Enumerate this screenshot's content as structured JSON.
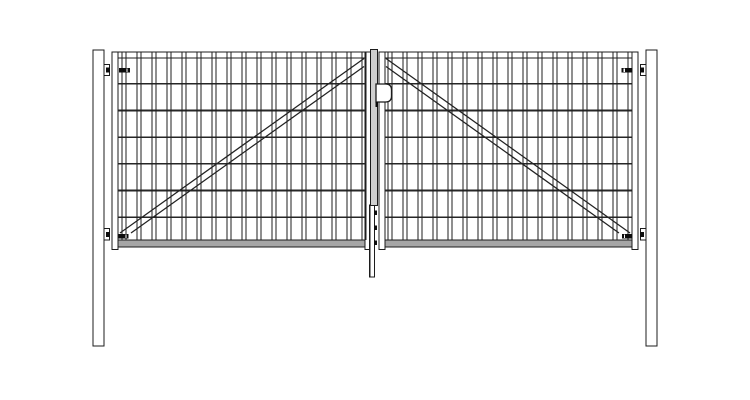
{
  "title": "Double-leaf wire-mesh swing gate - front elevation technical drawing",
  "canvas": {
    "width": 750,
    "height": 400,
    "background": "#ffffff"
  },
  "colors": {
    "outline": "#1c1c1c",
    "wire_vertical": "#1f1f1f",
    "wire_horizontal": "#262626",
    "brace": "#222222",
    "fill_white": "#ffffff",
    "fill_rail": "#a6a6a6",
    "fill_profile": "#cfcfcf",
    "fill_black": "#0d0d0d"
  },
  "posts": {
    "left": {
      "x": 93,
      "y": 50,
      "w": 11,
      "h": 296
    },
    "right": {
      "x": 646,
      "y": 50,
      "w": 11,
      "h": 296
    }
  },
  "leaves": {
    "left": {
      "frame": {
        "x1": 112,
        "x2": 371,
        "top": 52,
        "bottom": 247,
        "stile_w": 6,
        "top_rail_h": 6,
        "bottom_rail_y": 240,
        "stile_foot_y": 249.5
      },
      "mesh": {
        "bar_first_x": 122,
        "bar_last_x": 362,
        "bar_pitch": 15,
        "bar_pair_gap": 4,
        "bar_top_y": 52,
        "bar_bottom_y": 240,
        "wire_ys": [
          83.7,
          110.4,
          137.1,
          163.8,
          190.5,
          217.2
        ],
        "wire_x1": 118,
        "wire_x2": 365,
        "vertical_bar_count": 17,
        "horizontal_wire_count": 6
      },
      "brace_lines": [
        [
          120,
          233,
          364,
          58.5
        ],
        [
          131,
          233,
          364,
          66.5
        ]
      ]
    },
    "right": {
      "frame": {
        "x1": 379,
        "x2": 638,
        "top": 52,
        "bottom": 247,
        "stile_w": 6,
        "top_rail_h": 6,
        "bottom_rail_y": 240,
        "stile_foot_y": 249.5
      },
      "mesh": {
        "bar_first_x": 388,
        "bar_last_x": 628,
        "bar_pitch": 15,
        "bar_pair_gap": 4,
        "bar_top_y": 52,
        "bar_bottom_y": 240,
        "wire_ys": [
          83.7,
          110.4,
          137.1,
          163.8,
          190.5,
          217.2
        ],
        "wire_x1": 385,
        "wire_x2": 632,
        "vertical_bar_count": 17,
        "horizontal_wire_count": 6
      },
      "brace_lines": [
        [
          386,
          58.5,
          630,
          233
        ],
        [
          386,
          66.5,
          619,
          233
        ]
      ]
    }
  },
  "center": {
    "cover_profile": {
      "x": 370.5,
      "y": 49.5,
      "w": 7,
      "h": 156
    },
    "lock_plate": {
      "x": 376,
      "y": 84,
      "w": 15.5,
      "h": 18,
      "corner_r": 6
    },
    "latch_tab": {
      "x": 375.6,
      "y": 102,
      "w": 2.4,
      "h": 5
    },
    "drop_rod": {
      "x": 369.8,
      "y": 205,
      "w": 4.8,
      "bottom": 277
    },
    "rod_guide_clips": [
      {
        "x": 373.8,
        "y": 210.5,
        "w": 3.2,
        "h": 4.5
      },
      {
        "x": 373.8,
        "y": 225.5,
        "w": 3.2,
        "h": 4.5
      },
      {
        "x": 373.8,
        "y": 240.5,
        "w": 3.2,
        "h": 4.5
      }
    ]
  },
  "hinges": [
    {
      "id": "top-left",
      "bracket": {
        "x": 104,
        "y": 64.5,
        "w": 5.5,
        "h": 11
      },
      "pin": {
        "x": 106,
        "y": 67.5,
        "w": 4,
        "h": 5
      },
      "arm": {
        "x": 118.8,
        "y": 67.8,
        "w": 11,
        "h": 4.6
      },
      "arm_notch_x": 126.8
    },
    {
      "id": "bottom-left",
      "bracket": {
        "x": 104,
        "y": 228.5,
        "w": 5.5,
        "h": 11.5
      },
      "pin": {
        "x": 106,
        "y": 232,
        "w": 4,
        "h": 5
      },
      "arm": {
        "x": 118.5,
        "y": 233.8,
        "w": 10,
        "h": 4.6
      },
      "arm_notch_x": 125.8
    },
    {
      "id": "top-right",
      "bracket": {
        "x": 640.5,
        "y": 64.5,
        "w": 5.5,
        "h": 11
      },
      "pin": {
        "x": 640,
        "y": 67.5,
        "w": 4,
        "h": 5
      },
      "arm": {
        "x": 621.5,
        "y": 67.8,
        "w": 11,
        "h": 4.6
      },
      "arm_notch_x": 624.2
    },
    {
      "id": "bottom-right",
      "bracket": {
        "x": 640.5,
        "y": 228.5,
        "w": 5.5,
        "h": 11.5
      },
      "pin": {
        "x": 640,
        "y": 232,
        "w": 4,
        "h": 5
      },
      "arm": {
        "x": 622,
        "y": 233.8,
        "w": 10,
        "h": 4.6
      },
      "arm_notch_x": 624.6
    }
  ]
}
